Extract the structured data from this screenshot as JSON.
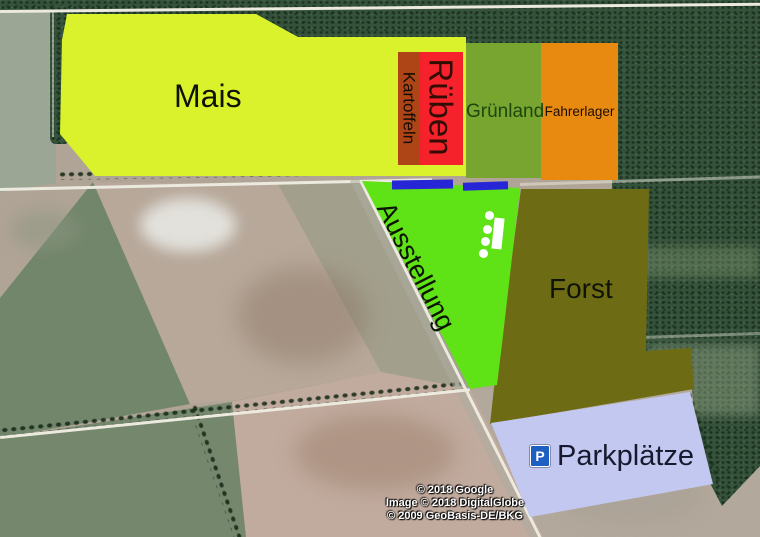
{
  "map": {
    "regions": [
      {
        "label": "Mais",
        "color": "#d9f22b",
        "text_color": "#101206"
      },
      {
        "label": "Kartoffeln",
        "color": "#ad4517",
        "text_color": "#150c05"
      },
      {
        "label": "Rüben",
        "color": "#f5222c",
        "text_color": "#330d04"
      },
      {
        "label": "Grünland",
        "color": "#77a52f",
        "text_color": "#1d470e"
      },
      {
        "label": "Fahrerlager",
        "color": "#e98a10",
        "text_color": "#1e0c03"
      },
      {
        "label": "Ausstellung",
        "color": "#5fe316",
        "text_color": "#0c1404"
      },
      {
        "label": "Forst",
        "color": "#6e6b15",
        "text_color": "#101408"
      },
      {
        "label": "Parkplätze",
        "color": "#c3c8f1",
        "text_color": "#171a2e"
      }
    ],
    "parking_sign": {
      "glyph": "P",
      "color": "#1d5fc2"
    },
    "overlay_marks": {
      "blue_bar_color": "#2626d6",
      "building_color": "#ffffff"
    },
    "attribution": [
      "© 2018 Google",
      "Image © 2018 DigitalGlobe",
      "© 2009 GeoBasis-DE/BKG"
    ]
  }
}
